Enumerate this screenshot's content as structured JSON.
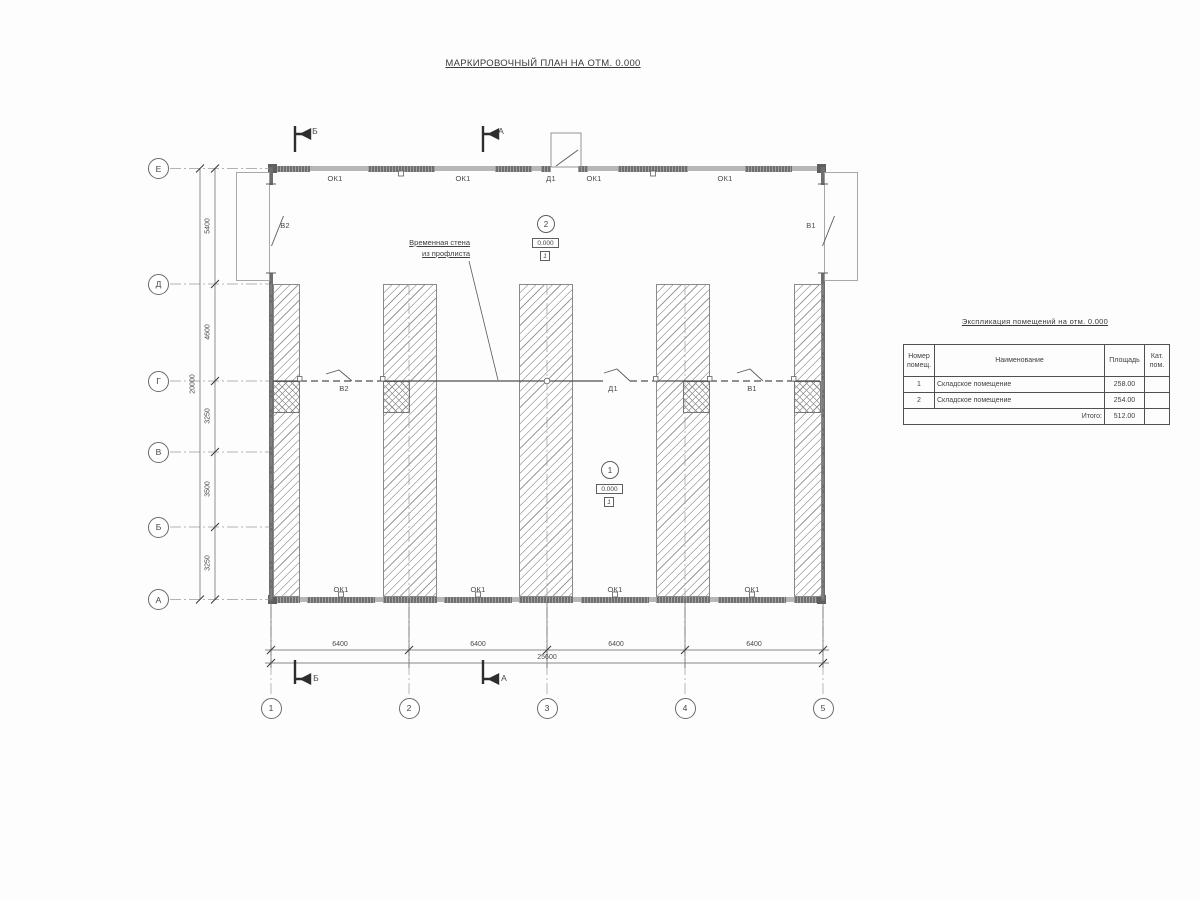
{
  "title": "МАРКИРОВОЧНЫЙ ПЛАН НА ОТМ. 0.000",
  "plan": {
    "grid_rows": [
      "Е",
      "Д",
      "Г",
      "В",
      "Б",
      "А"
    ],
    "grid_cols": [
      "1",
      "2",
      "3",
      "4",
      "5"
    ],
    "dims_left": [
      "5400",
      "4600",
      "3250",
      "3500",
      "3250"
    ],
    "dims_left_total": "20000",
    "dims_bottom": [
      "6400",
      "6400",
      "6400",
      "6400"
    ],
    "dims_bottom_total": "25600",
    "marks": {
      "window": "ОК1",
      "door": "Д1",
      "gate_left": "В2",
      "gate_right": "В1"
    },
    "note": {
      "line1": "Временная стена",
      "line2": "из профлиста"
    },
    "rooms": [
      {
        "number": "1",
        "elevation": "0.000",
        "floor": "1"
      },
      {
        "number": "2",
        "elevation": "0.000",
        "floor": "1"
      }
    ],
    "sections": {
      "a": "А",
      "b": "Б"
    }
  },
  "table": {
    "title": "Экспликация помещений на отм. 0.000",
    "headers": {
      "number": "Номер помещ.",
      "name": "Наименование",
      "area": "Площадь",
      "cat": "Кат. пом."
    },
    "rows": [
      {
        "number": "1",
        "name": "Складское помещение",
        "area": "258.00",
        "cat": ""
      },
      {
        "number": "2",
        "name": "Складское помещение",
        "area": "254.00",
        "cat": ""
      }
    ],
    "total_label": "Итого:",
    "total_area": "512.00"
  }
}
